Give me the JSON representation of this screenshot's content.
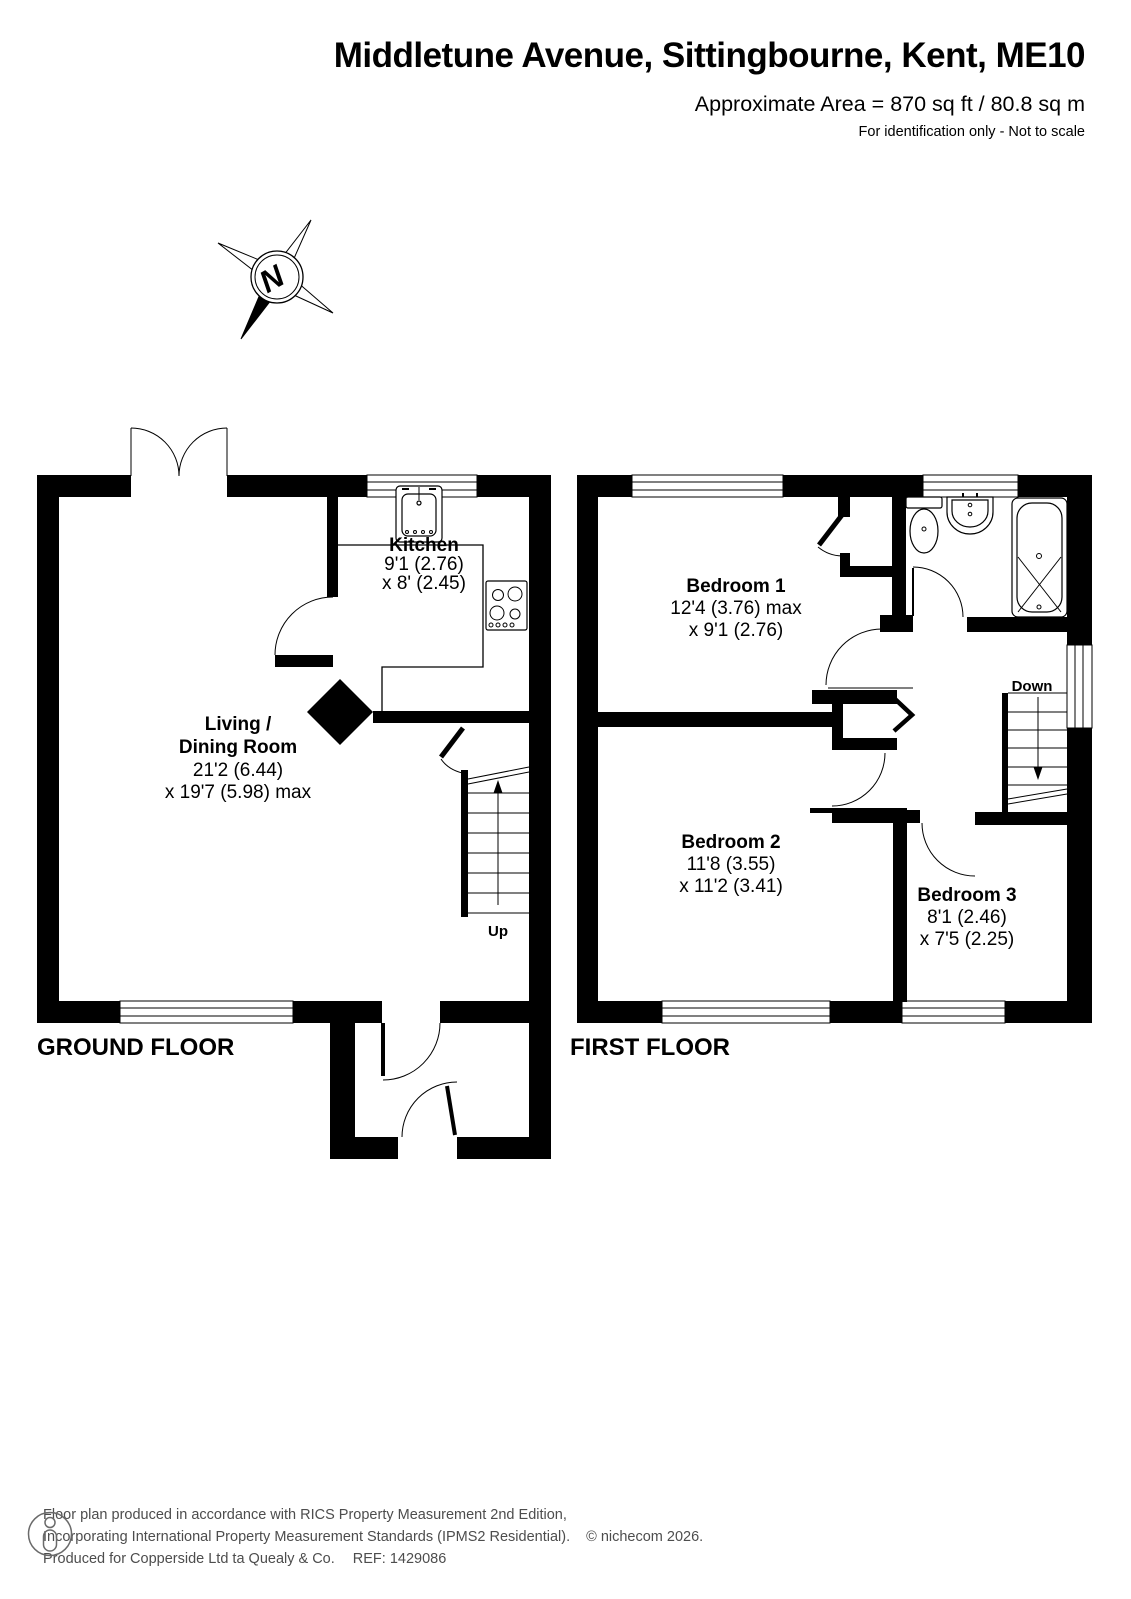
{
  "header": {
    "title": "Middletune Avenue, Sittingbourne, Kent, ME10",
    "area": "Approximate Area = 870 sq ft / 80.8 sq m",
    "note": "For identification only - Not to scale"
  },
  "compass": {
    "north": "N"
  },
  "ground_floor": {
    "label": "GROUND FLOOR",
    "stairs": "Up",
    "kitchen": {
      "name": "Kitchen",
      "dim1": "9'1 (2.76)",
      "dim2": "x 8' (2.45)"
    },
    "living": {
      "name1": "Living /",
      "name2": "Dining Room",
      "dim1": "21'2 (6.44)",
      "dim2": "x 19'7 (5.98) max"
    }
  },
  "first_floor": {
    "label": "FIRST FLOOR",
    "stairs": "Down",
    "bedroom1": {
      "name": "Bedroom 1",
      "dim1": "12'4 (3.76) max",
      "dim2": "x 9'1 (2.76)"
    },
    "bedroom2": {
      "name": "Bedroom 2",
      "dim1": "11'8 (3.55)",
      "dim2": "x 11'2 (3.41)"
    },
    "bedroom3": {
      "name": "Bedroom 3",
      "dim1": "8'1 (2.46)",
      "dim2": "x 7'5 (2.25)"
    }
  },
  "footer": {
    "line1": "Floor plan produced in accordance with RICS Property Measurement 2nd Edition,",
    "line2": "Incorporating International Property Measurement Standards (IPMS2 Residential).",
    "copyright": "© nichecom 2026.",
    "produced": "Produced for Copperside Ltd ta Quealy & Co.",
    "ref": "REF: 1429086"
  }
}
